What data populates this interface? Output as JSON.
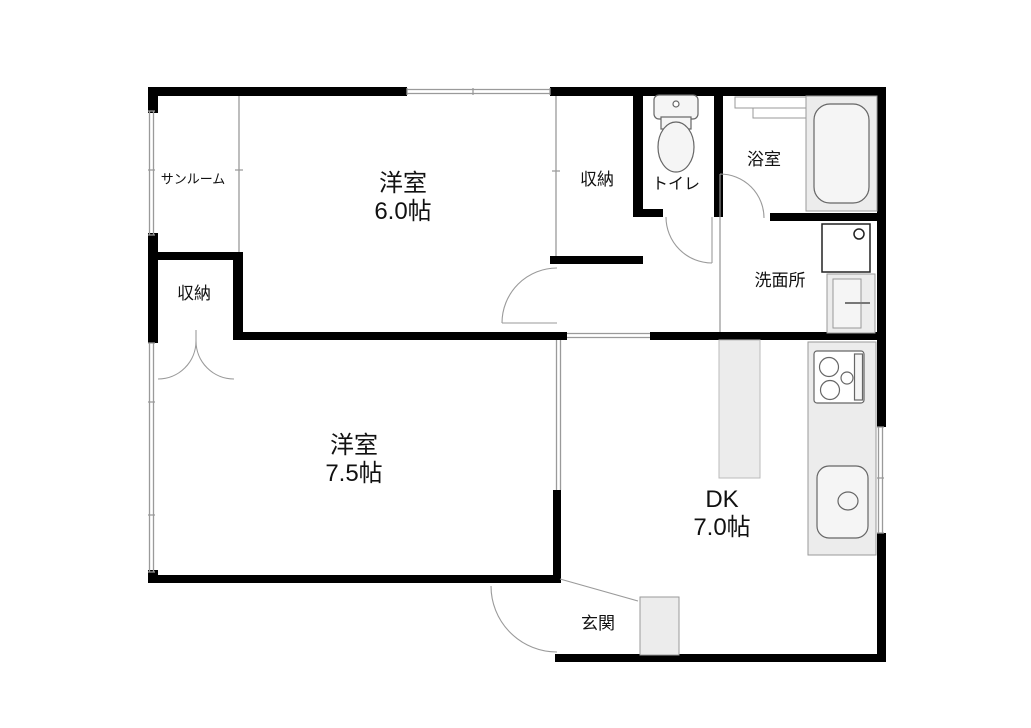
{
  "plan_title": "apartment-floor-plan",
  "colors": {
    "wall": "#000000",
    "thin_line": "#9a9a9a",
    "fixture_fill": "#ececec",
    "fixture_stroke": "#666666",
    "text": "#111111"
  },
  "rooms": {
    "sunroom": {
      "label": "サンルーム"
    },
    "bedroom6": {
      "label": "洋室",
      "size": "6.0帖"
    },
    "closet_top": {
      "label": "収納"
    },
    "toilet": {
      "label": "トイレ"
    },
    "bath": {
      "label": "浴室"
    },
    "washroom": {
      "label": "洗面所"
    },
    "closet_left": {
      "label": "収納"
    },
    "bedroom75": {
      "label": "洋室",
      "size": "7.5帖"
    },
    "dk": {
      "label": "DK",
      "size": "7.0帖"
    },
    "entrance": {
      "label": "玄関"
    }
  },
  "fixtures": [
    "toilet-icon",
    "bathtub-icon",
    "bath-counter-icon",
    "washing-machine-icon",
    "vanity-sink-icon",
    "kitchen-counter-icon",
    "stove-icon",
    "kitchen-sink-icon",
    "shoe-cabinet-icon",
    "door-swing-icon",
    "window-icon"
  ]
}
